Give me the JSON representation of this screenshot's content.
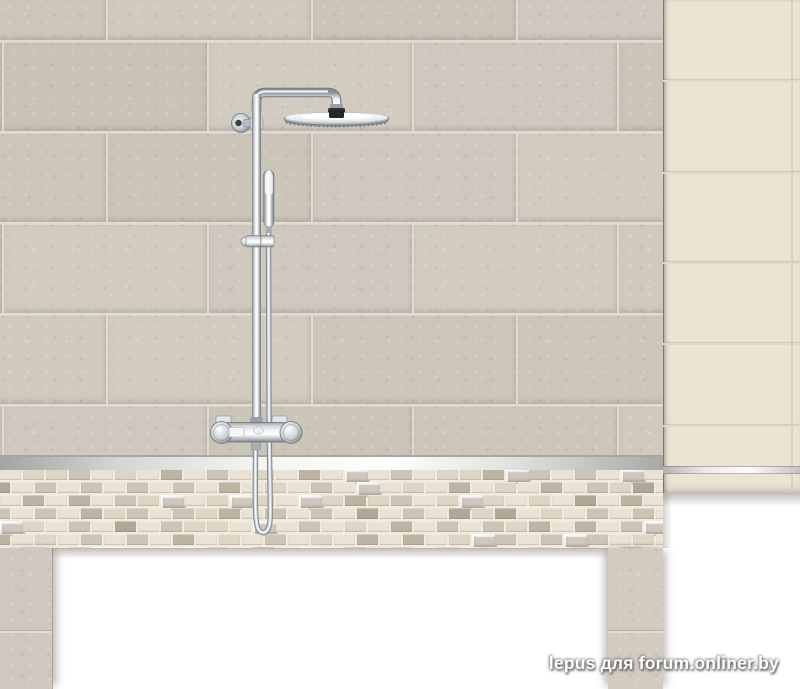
{
  "scene": {
    "description": "Product photo: chrome thermostatic rain-shower system mounted on a beige tiled bathroom wall with mosaic border, cream accent panel and white bathtub cut-out",
    "watermark": "lepus для forum.onliner.by"
  },
  "palette": {
    "background_white": "#ffffff",
    "wall_grout": "#e0dcd4",
    "wall_tile_variants": [
      "#cdc6bb",
      "#d1cbc0",
      "#c9c2b6",
      "#cfc8be",
      "#cbc4b8",
      "#d0c9bd"
    ],
    "accent_panel": "#eae4d5",
    "accent_panel_grout": "#e0d9c8",
    "mosaic_grout": "#efebe1",
    "mosaic_palette": [
      "#eae3d4",
      "#ded6c5",
      "#cdc4b5",
      "#beb4a4",
      "#b2a797"
    ],
    "mosaic_bevel_face": "#cfc8be",
    "trim_metal_light": "#ffffff",
    "trim_metal_dark": "#96948f",
    "chrome_light": "#f8fafb",
    "chrome_mid": "#c3c8cd",
    "chrome_dark": "#6f767d",
    "shower_head_mount": "#2e3338"
  },
  "fixture": {
    "parts": [
      "wall-bracket",
      "shower-arm",
      "rain-shower-head",
      "shower-pipe",
      "hand-shower",
      "slider-clamp",
      "shower-hose",
      "thermostat-valve"
    ]
  }
}
